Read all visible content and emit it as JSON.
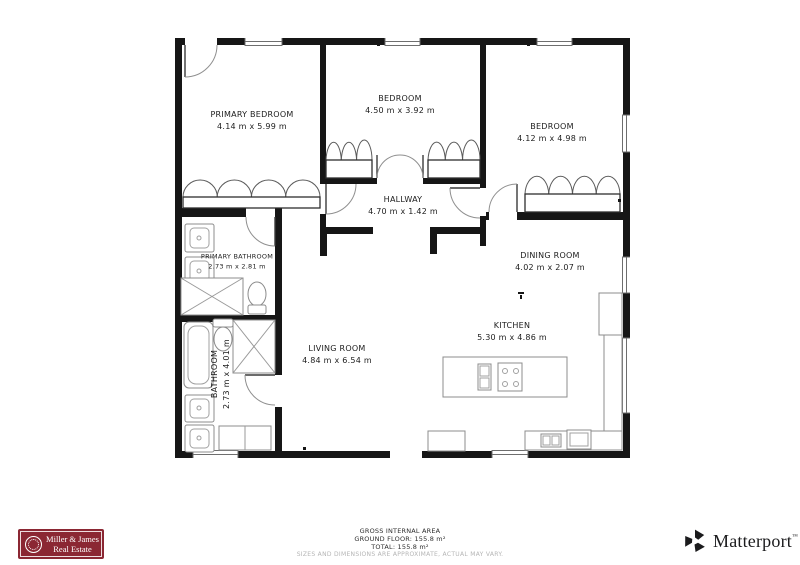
{
  "floorplan": {
    "rooms": [
      {
        "id": "primary-bedroom",
        "name": "PRIMARY BEDROOM",
        "dims": "4.14 m x 5.99 m"
      },
      {
        "id": "bedroom-top",
        "name": "BEDROOM",
        "dims": "4.50 m x 3.92 m"
      },
      {
        "id": "bedroom-right",
        "name": "BEDROOM",
        "dims": "4.12 m x 4.98 m"
      },
      {
        "id": "hallway",
        "name": "HALLWAY",
        "dims": "4.70 m x 1.42 m"
      },
      {
        "id": "primary-bathroom",
        "name": "PRIMARY BATHROOM",
        "dims": "2.73 m x 2.81 m"
      },
      {
        "id": "bathroom",
        "name": "BATHROOM",
        "dims": "2.73 m x 4.01 m"
      },
      {
        "id": "dining-room",
        "name": "DINING ROOM",
        "dims": "4.02 m x 2.07 m"
      },
      {
        "id": "kitchen",
        "name": "KITCHEN",
        "dims": "5.30 m x 4.86 m"
      },
      {
        "id": "living-room",
        "name": "LIVING ROOM",
        "dims": "4.84 m x 6.54 m"
      }
    ],
    "wall_color": "#161616"
  },
  "footer": {
    "area_title": "GROSS INTERNAL AREA",
    "ground_floor": "GROUND FLOOR: 155.8 m²",
    "total": "TOTAL: 155.8 m²",
    "disclaimer": "SIZES AND DIMENSIONS ARE APPROXIMATE, ACTUAL MAY VARY."
  },
  "branding": {
    "agency": {
      "line1": "Miller & James",
      "line2": "Real Estate",
      "bg_color": "#8b2733"
    },
    "matterport": {
      "label": "Matterport",
      "trademark": "™",
      "color": "#1b1b1d"
    }
  }
}
